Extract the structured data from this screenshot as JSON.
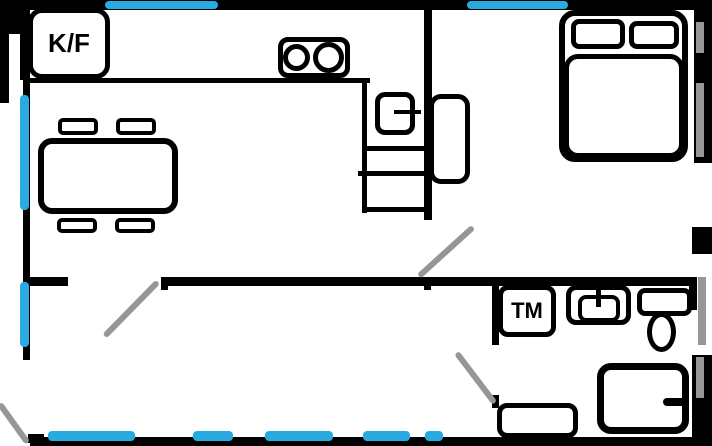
{
  "floorplan": {
    "labels": {
      "fridge_freezer": "K/F",
      "washing_machine": "TM"
    },
    "colors": {
      "wall": "#000000",
      "window": "#29ABE2",
      "door_swing": "#969696",
      "background": "#ffffff"
    },
    "icons": [
      "fridge-freezer-box",
      "stove-two-burners",
      "kitchen-sink-with-faucet",
      "counter-cabinets",
      "dining-table",
      "chair",
      "double-bed",
      "pillow",
      "wardrobe",
      "washing-machine-box",
      "washbasin",
      "toilet",
      "shower",
      "cabinet",
      "door-swing",
      "window-segment"
    ]
  }
}
